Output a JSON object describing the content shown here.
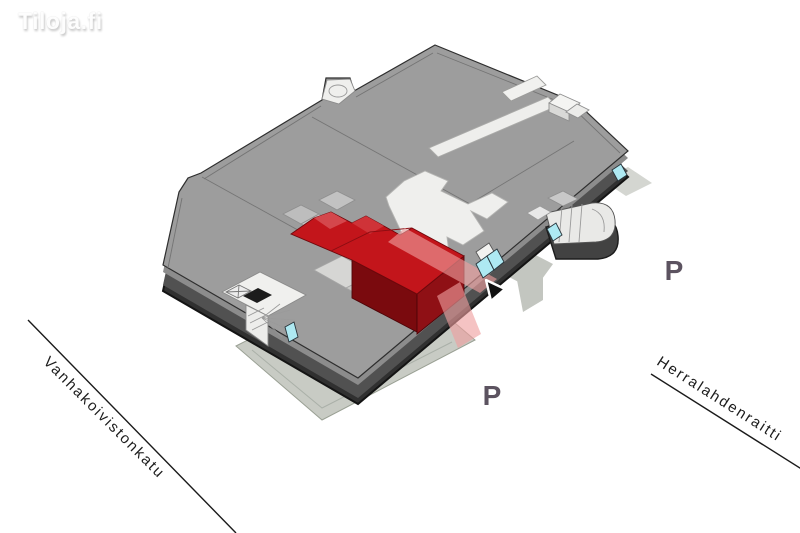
{
  "logo": {
    "text": "Tiloja.fi"
  },
  "streets": {
    "left": "Vanhakoivistonkatu",
    "right": "Herralahdenraitti"
  },
  "parking": {
    "south": "P",
    "east": "P"
  },
  "map": {
    "type": "isometric-floor-plan",
    "highlighted_unit_color": "#c3151b",
    "highlighted_unit_side_color": "#8f1015",
    "entrance_path_color": "#ef9e9e",
    "door_marker_color": "#aee9f2",
    "floor_color": "#9d9d9d",
    "wall_color": "#4f4f4f",
    "ground_color": "#c8cbc4",
    "street_line_color": "#1a1a1a"
  }
}
